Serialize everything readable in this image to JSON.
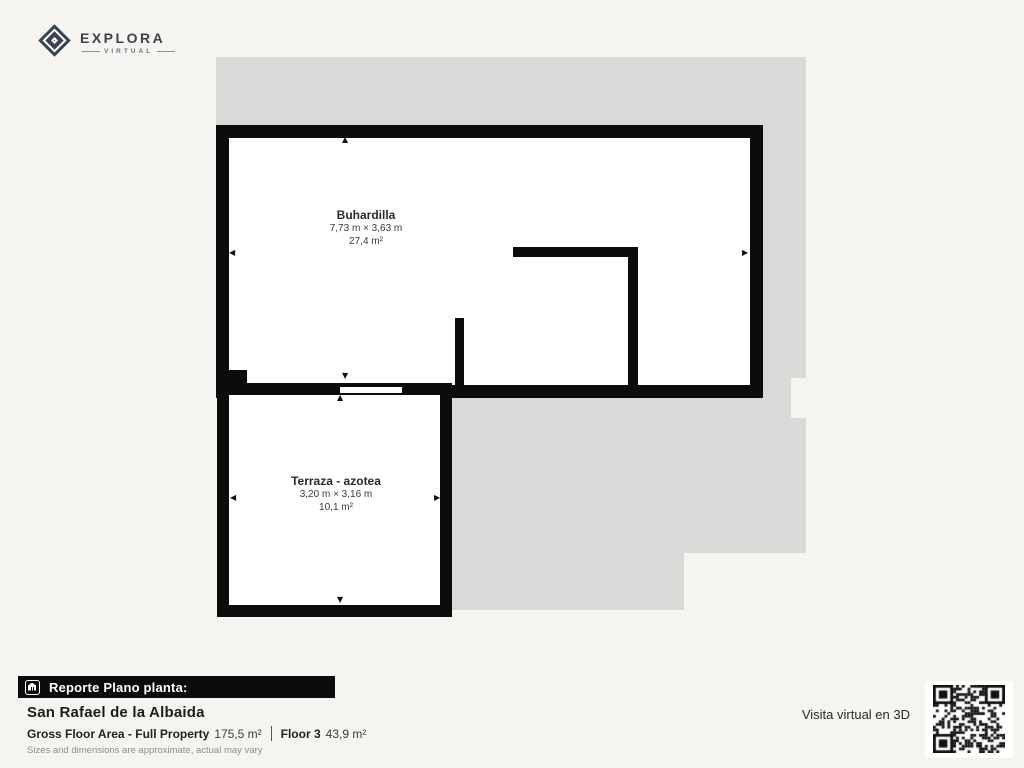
{
  "logo": {
    "name": "EXPLORA",
    "subtitle": "VIRTUAL"
  },
  "plan": {
    "rooms": [
      {
        "name": "Buhardilla",
        "dimensions": "7,73 m × 3,63 m",
        "area": "27,4 m²"
      },
      {
        "name": "Terraza - azotea",
        "dimensions": "3,20 m × 3,16 m",
        "area": "10,1 m²"
      }
    ]
  },
  "icons": {
    "arrow_up": "▲",
    "arrow_down": "▼",
    "arrow_left": "◀",
    "arrow_right": "▶"
  },
  "footer": {
    "report_label": "Reporte Plano planta:",
    "property_name": "San Rafael de la Albaida",
    "gross_label": "Gross Floor Area - Full Property",
    "gross_value": "175,5 m²",
    "floor_label": "Floor 3",
    "floor_value": "43,9 m²",
    "disclaimer": "Sizes and dimensions are approximate, actual may vary",
    "qr_caption": "Visita virtual en 3D"
  },
  "colors": {
    "plan_footprint_gray": "#d9d9d7",
    "wall_black": "#0c0c0c",
    "page_background": "#f5f4f1",
    "logo_slate": "#3b4252"
  }
}
